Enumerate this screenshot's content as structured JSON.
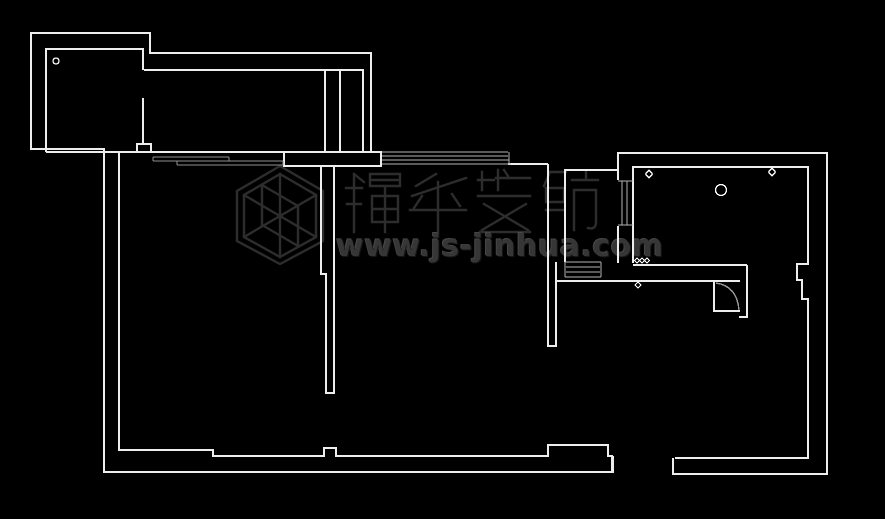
{
  "canvas": {
    "width": 885,
    "height": 519,
    "background_color": "#000000",
    "wall_line_color": "#ededed",
    "window_line_color": "#b3b3b3",
    "door_arc_color": "#9a9a9a",
    "marker_color": "#ffffff"
  },
  "watermark": {
    "brand_text": "锦华装饰",
    "url": "www.js-jinhua.com",
    "text_color": "#363636",
    "logo_name": "jinhua-cube-logo"
  },
  "plan_markers": [
    {
      "name": "balcony-circle-marker"
    },
    {
      "name": "room-circle-marker"
    },
    {
      "name": "room-diamond-marker-left"
    },
    {
      "name": "room-diamond-marker-right"
    },
    {
      "name": "triple-diamond-marker"
    },
    {
      "name": "door-diamond-marker"
    },
    {
      "name": "wall-dot-marker"
    }
  ]
}
